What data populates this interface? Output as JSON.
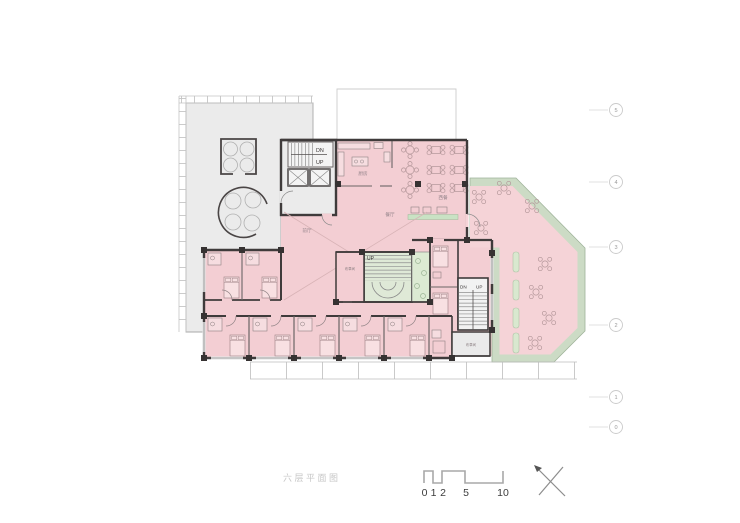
{
  "drawing": {
    "title": "六层平面图",
    "rooms": {
      "kitchen": "厨房",
      "western_restaurant": "西餐",
      "restaurant": "餐厅",
      "lobby": "前厅",
      "service_room_center": "布草间",
      "service_room_right": "布草间"
    },
    "stairs": {
      "top_down": "DN",
      "top_up": "UP",
      "center_up": "UP",
      "right_down": "DN",
      "right_up": "UP"
    }
  },
  "grid_bubbles": [
    {
      "label": "5"
    },
    {
      "label": "4"
    },
    {
      "label": "3"
    },
    {
      "label": "2"
    },
    {
      "label": "1"
    },
    {
      "label": "0"
    }
  ],
  "scale_bar": {
    "labels": [
      "0",
      "1",
      "2",
      "5",
      "10"
    ]
  },
  "colors": {
    "room_pink": "#f3ced3",
    "terrace_gray": "#ebebeb",
    "landscape_green": "#ccdbc5",
    "planter_green": "#d9e8cf",
    "stair_green": "#dfe9d7",
    "wall_dark": "#3f3b3b"
  }
}
